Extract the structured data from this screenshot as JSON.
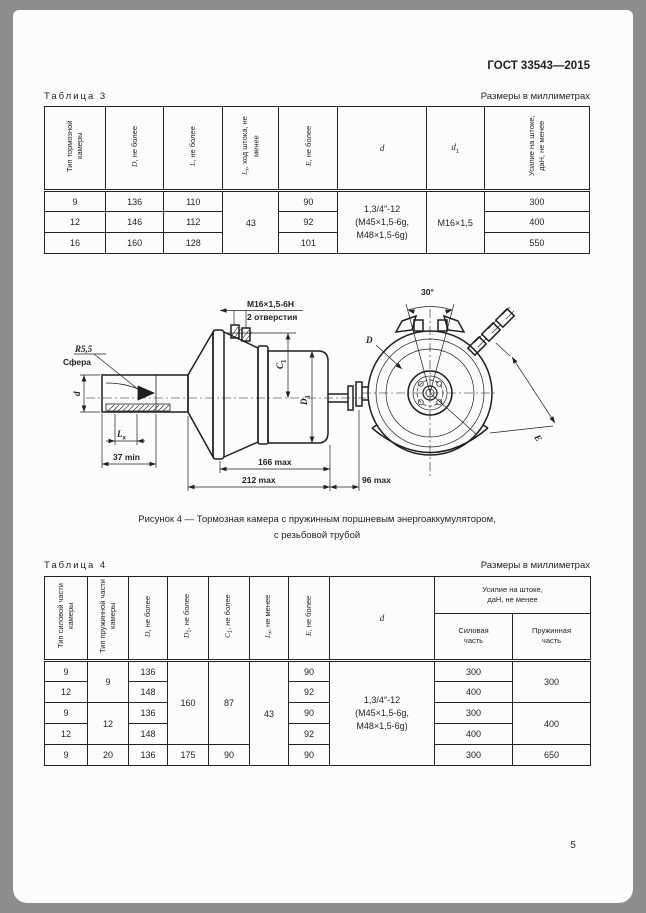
{
  "doc": {
    "number": "ГОСТ 33543—2015",
    "page_number": "5"
  },
  "table3": {
    "title": "Таблица 3",
    "units_note": "Размеры в миллиметрах",
    "headers": {
      "type": "Тип тормозной камеры",
      "D_sym": "D",
      "D_rest": ", не более",
      "L_sym": "L",
      "L_rest": ", не более",
      "Lx_sym": "L",
      "Lx_sub": "х",
      "Lx_rest": ", ход штока, не менее",
      "E_sym": "E",
      "E_rest": ", не более",
      "d_sym": "d",
      "d1_sym": "d",
      "d1_sub": "1",
      "force": "Усилие на штоке, даН, не менее"
    },
    "merged": {
      "stroke": "43",
      "d_thread": "1,3/4″-12\n(М45×1,5-6g,\nМ48×1,5-6g)",
      "d1_thread": "М16×1,5"
    },
    "rows": [
      {
        "type": "9",
        "D": "136",
        "L": "110",
        "E": "90",
        "force": "300"
      },
      {
        "type": "12",
        "D": "146",
        "L": "112",
        "E": "92",
        "force": "400"
      },
      {
        "type": "16",
        "D": "160",
        "L": "128",
        "E": "101",
        "force": "550"
      }
    ]
  },
  "figure": {
    "caption_line1": "Рисунок 4 — Тормозная камера с пружинным поршневым энергоаккумулятором,",
    "caption_line2": "с резьбовой трубой",
    "labels": {
      "thread": "М16×1,5-6Н",
      "holes": "2 отверстия",
      "radius": "R5,5",
      "sphere": "Сфера",
      "d_sym": "d",
      "lx_sym": "L",
      "lx_sub": "х",
      "dim_37": "37 min",
      "c1_sym": "C",
      "c1_sub": "1",
      "d1_sym": "D",
      "d1_sub": "1",
      "dim_166": "166 max",
      "dim_212": "212 max",
      "dim_96": "96 max",
      "angle_30": "30°",
      "D_sym": "D",
      "E_sym": "E"
    }
  },
  "table4": {
    "title": "Таблица 4",
    "units_note": "Размеры в миллиметрах",
    "headers": {
      "type_power": "Тип силовой части камеры",
      "type_spring": "Тип пружинной части камеры",
      "D_sym": "D",
      "D_rest": ", не более",
      "D1_sym": "D",
      "D1_sub": "1",
      "D1_rest": ", не более",
      "C1_sym": "C",
      "C1_sub": "1",
      "C1_rest": ", не более",
      "Lx_sym": "L",
      "Lx_sub": "х",
      "Lx_rest": ", не менее",
      "E_sym": "E",
      "E_rest": ", не более",
      "d_sym": "d",
      "force_group": "Усилие на штоке,\nдаН, не менее",
      "force_power": "Силовая\nчасть",
      "force_spring": "Пружинная\nчасть"
    },
    "merged": {
      "spring_9": "9",
      "spring_12": "12",
      "D1": "160",
      "C1": "87",
      "Lx": "43",
      "d_thread": "1,3/4″-12\n(М45×1,5-6g,\nМ48×1,5-6g)",
      "force_spring_300": "300",
      "force_spring_400": "400"
    },
    "rows": [
      {
        "power": "9",
        "D": "136",
        "E": "90",
        "force_power": "300"
      },
      {
        "power": "12",
        "D": "148",
        "E": "92",
        "force_power": "400"
      },
      {
        "power": "9",
        "D": "136",
        "E": "90",
        "force_power": "300"
      },
      {
        "power": "12",
        "D": "148",
        "E": "92",
        "force_power": "400"
      },
      {
        "power": "9",
        "spring": "20",
        "D": "136",
        "D1": "175",
        "C1": "90",
        "E": "90",
        "force_power": "300",
        "force_spring": "650"
      }
    ]
  }
}
